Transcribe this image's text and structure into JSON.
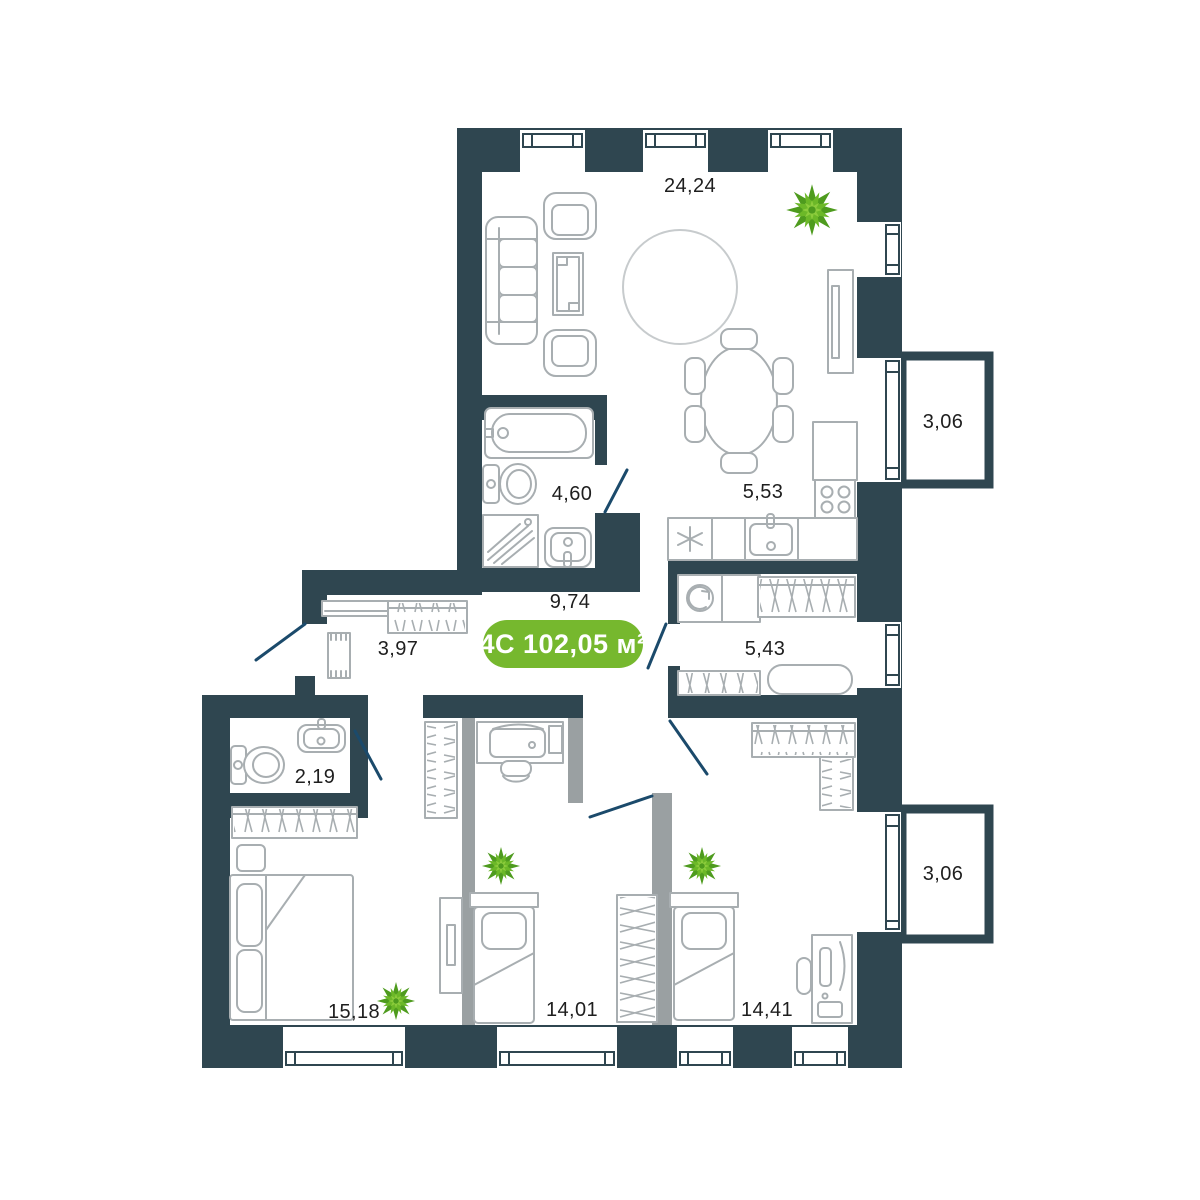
{
  "plan": {
    "badge": {
      "type": "4С",
      "area": "102,05 м²"
    },
    "labels": {
      "living": "24,24",
      "bath": "4,60",
      "kitchen": "5,53",
      "hall": "9,74",
      "laundry": "5,43",
      "corridor": "3,97",
      "wc": "2,19",
      "bedroom_main": "15,18",
      "bedroom_left": "14,01",
      "bedroom_right": "14,41",
      "balcony_top": "3,06",
      "balcony_bottom": "3,06"
    },
    "colors": {
      "wall": "#2f4650",
      "furniture": "#a8aeb1",
      "partition": "#9aa0a2",
      "door": "#1b4a6b",
      "accent": "#76b82e",
      "rug": "#c7cbcd",
      "plantDark": "#4e9b1e",
      "plantLight": "#6cb828",
      "plantMid": "#8ccc3c"
    }
  }
}
